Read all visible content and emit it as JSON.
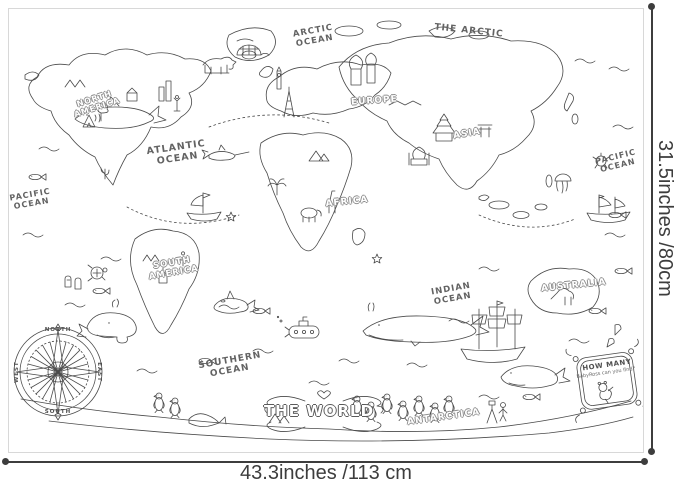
{
  "product": {
    "poster": {
      "title": "THE WORLD",
      "regions": {
        "the_arctic": "THE ARCTIC",
        "north_america": "NORTH AMERICA",
        "south_america": "SOUTH AMERICA",
        "europe": "EUROPE",
        "asia": "ASIA",
        "africa": "AFRICA",
        "australia": "AUSTRALIA",
        "antarctica": "ANTARCTICA"
      },
      "oceans": {
        "arctic": "ARCTIC OCEAN",
        "pacific_west": "PACIFIC OCEAN",
        "pacific_east": "PACIFIC OCEAN",
        "atlantic": "ATLANTIC OCEAN",
        "indian": "INDIAN OCEAN",
        "southern": "SOUTHERN OCEAN"
      },
      "compass": {
        "north": "NORTH",
        "south": "SOUTH",
        "east": "EAST",
        "west": "WEST"
      },
      "sign": {
        "heading": "HOW MANY",
        "subtext": "BabyRoss can you find?"
      }
    },
    "dimensions": {
      "width_label": "43.3inches /113 cm",
      "height_label": "31.5inches /80cm"
    },
    "colors": {
      "line_art": "#4a4a4a",
      "dimension_text": "#3d3d3d",
      "poster_border": "#d8d8d8"
    }
  }
}
